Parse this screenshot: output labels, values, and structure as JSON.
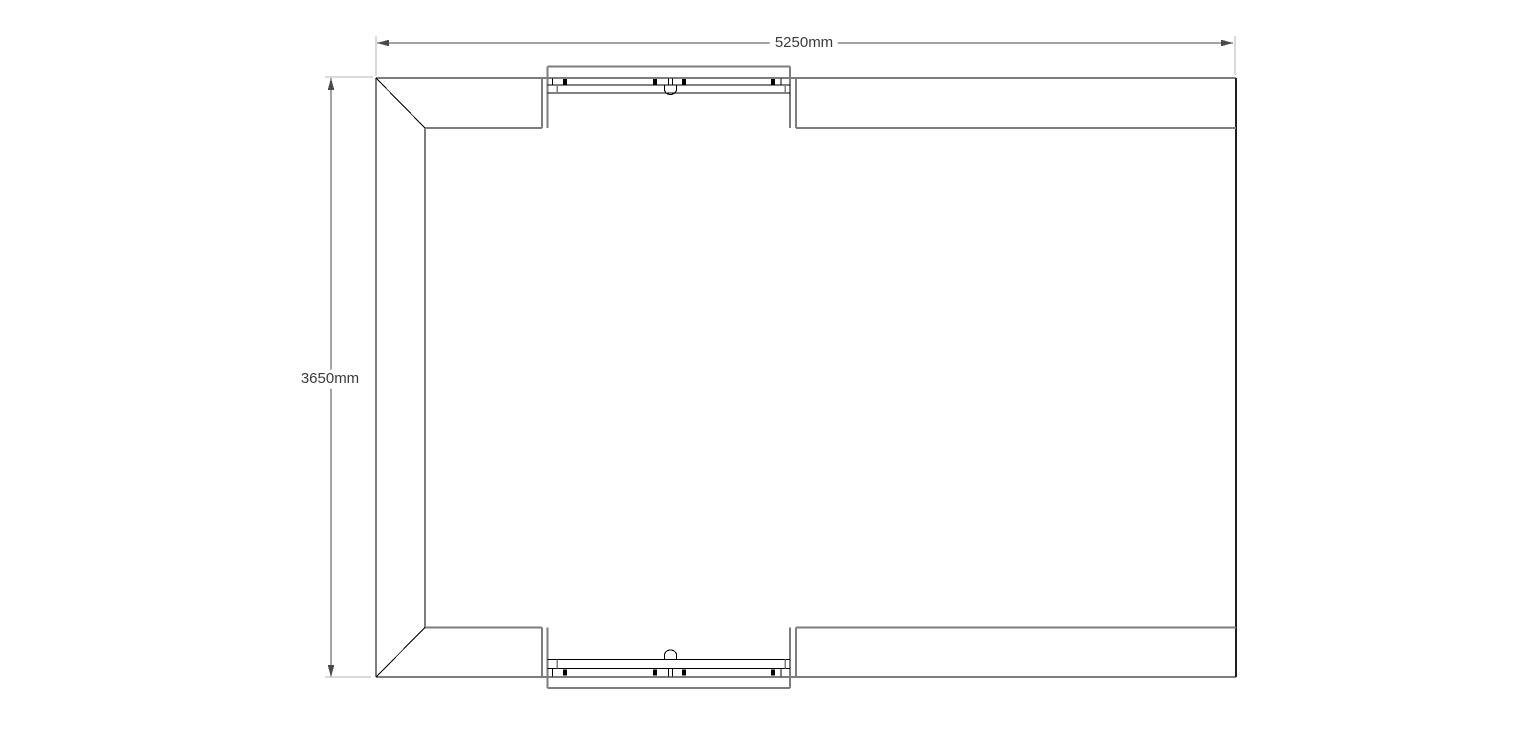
{
  "page": {
    "background": "#ffffff",
    "description": "CAD floor plan drawing, 5250mm x 3650mm unit with splayed left corners and sliding windows top and bottom"
  },
  "drawing": {
    "colors": {
      "wall": "#7d7d7d",
      "wall_dark": "#1f1f1f",
      "detail": "#000000",
      "dimension": "#4a4a4a",
      "extension": "#b4b4b4",
      "text": "#3a3a3a"
    },
    "dimensions": [
      {
        "id": "width",
        "label": "5250mm",
        "value_mm": 5250,
        "orientation": "horizontal",
        "label_center": {
          "x": 804,
          "y": 43
        }
      },
      {
        "id": "height",
        "label": "3650mm",
        "value_mm": 3650,
        "orientation": "vertical",
        "label_center": {
          "x": 330,
          "y": 379
        }
      }
    ],
    "elements": [
      {
        "name": "width-dim-line",
        "type": "line",
        "x1": 377,
        "y1": 43,
        "x2": 1233,
        "y2": 43,
        "stroke": "dimension",
        "w": 1
      },
      {
        "name": "width-dim-arrow-left",
        "type": "polygon",
        "points": "377,43 389,39.7 389,46.3",
        "fill": "dimension"
      },
      {
        "name": "width-dim-arrow-right",
        "type": "polygon",
        "points": "1233,43 1221,39.7 1221,46.3",
        "fill": "dimension"
      },
      {
        "name": "width-ext-line-left",
        "type": "line",
        "x1": 376,
        "y1": 36,
        "x2": 376,
        "y2": 76,
        "stroke": "extension",
        "w": 1
      },
      {
        "name": "width-ext-line-right",
        "type": "line",
        "x1": 1235,
        "y1": 36,
        "x2": 1235,
        "y2": 75,
        "stroke": "extension",
        "w": 1
      },
      {
        "name": "height-dim-line",
        "type": "line",
        "x1": 331,
        "y1": 78,
        "x2": 331,
        "y2": 677,
        "stroke": "dimension",
        "w": 1
      },
      {
        "name": "height-dim-arrow-top",
        "type": "polygon",
        "points": "331,78 327.7,90 334.3,90",
        "fill": "dimension"
      },
      {
        "name": "height-dim-arrow-bottom",
        "type": "polygon",
        "points": "331,677 327.7,665 334.3,665",
        "fill": "dimension"
      },
      {
        "name": "height-ext-line-top",
        "type": "line",
        "x1": 325,
        "y1": 77,
        "x2": 373,
        "y2": 77,
        "stroke": "extension",
        "w": 1
      },
      {
        "name": "height-ext-line-bottom",
        "type": "line",
        "x1": 325,
        "y1": 677,
        "x2": 371,
        "y2": 677,
        "stroke": "extension",
        "w": 1
      },
      {
        "name": "left-outer-wall",
        "type": "line",
        "x1": 376,
        "y1": 78,
        "x2": 376,
        "y2": 677,
        "stroke": "wall",
        "w": 2
      },
      {
        "name": "top-outer-wall",
        "type": "line",
        "x1": 376,
        "y1": 78,
        "x2": 1236,
        "y2": 78,
        "stroke": "wall",
        "w": 2
      },
      {
        "name": "bottom-outer-wall",
        "type": "line",
        "x1": 376,
        "y1": 677,
        "x2": 1236,
        "y2": 677,
        "stroke": "wall",
        "w": 2
      },
      {
        "name": "right-wall",
        "type": "line",
        "x1": 1236,
        "y1": 78,
        "x2": 1236,
        "y2": 677,
        "stroke": "wall_dark",
        "w": 2
      },
      {
        "name": "left-inner-wall",
        "type": "line",
        "x1": 425,
        "y1": 128,
        "x2": 425,
        "y2": 627.5,
        "stroke": "wall",
        "w": 2
      },
      {
        "name": "top-inner-wall-left",
        "type": "line",
        "x1": 425,
        "y1": 128,
        "x2": 542,
        "y2": 128,
        "stroke": "wall",
        "w": 2
      },
      {
        "name": "top-inner-wall-right",
        "type": "line",
        "x1": 796,
        "y1": 128,
        "x2": 1236,
        "y2": 128,
        "stroke": "wall",
        "w": 2
      },
      {
        "name": "bottom-inner-wall-left",
        "type": "line",
        "x1": 425,
        "y1": 627.5,
        "x2": 542,
        "y2": 627.5,
        "stroke": "wall",
        "w": 2
      },
      {
        "name": "bottom-inner-wall-right",
        "type": "line",
        "x1": 796,
        "y1": 627.5,
        "x2": 1236,
        "y2": 627.5,
        "stroke": "wall",
        "w": 2
      },
      {
        "name": "top-left-chamfer",
        "type": "line",
        "x1": 376,
        "y1": 78,
        "x2": 425,
        "y2": 128,
        "stroke": "detail",
        "w": 1
      },
      {
        "name": "bottom-left-chamfer",
        "type": "line",
        "x1": 376,
        "y1": 677,
        "x2": 425,
        "y2": 627.5,
        "stroke": "detail",
        "w": 1
      },
      {
        "name": "top-window-opening-left",
        "type": "line",
        "x1": 542,
        "y1": 78,
        "x2": 542,
        "y2": 128,
        "stroke": "wall",
        "w": 2
      },
      {
        "name": "top-window-opening-right",
        "type": "line",
        "x1": 796,
        "y1": 78,
        "x2": 796,
        "y2": 128,
        "stroke": "wall",
        "w": 2
      },
      {
        "name": "top-window-jamb-left",
        "type": "line",
        "x1": 547.5,
        "y1": 66.5,
        "x2": 547.5,
        "y2": 128,
        "stroke": "wall",
        "w": 2
      },
      {
        "name": "top-window-jamb-right",
        "type": "line",
        "x1": 790,
        "y1": 66.5,
        "x2": 790,
        "y2": 128,
        "stroke": "wall",
        "w": 2
      },
      {
        "name": "top-window-frame-outer",
        "type": "line",
        "x1": 547.5,
        "y1": 66.5,
        "x2": 790,
        "y2": 66.5,
        "stroke": "wall",
        "w": 2
      },
      {
        "name": "top-window-rail-1",
        "type": "line",
        "x1": 547.5,
        "y1": 85,
        "x2": 790,
        "y2": 85,
        "stroke": "detail",
        "w": 1
      },
      {
        "name": "top-window-rail-2",
        "type": "line",
        "x1": 547.5,
        "y1": 93,
        "x2": 790,
        "y2": 93,
        "stroke": "detail",
        "w": 1
      },
      {
        "name": "top-window-lock-block",
        "type": "rect",
        "x": 563.2,
        "y": 79,
        "width": 3.6,
        "height": 6,
        "fill": "detail"
      },
      {
        "name": "top-window-lock-block",
        "type": "rect",
        "x": 653.2,
        "y": 79,
        "width": 3.6,
        "height": 6,
        "fill": "detail"
      },
      {
        "name": "top-window-lock-block",
        "type": "rect",
        "x": 682.2,
        "y": 79,
        "width": 3.6,
        "height": 6,
        "fill": "detail"
      },
      {
        "name": "top-window-lock-block",
        "type": "rect",
        "x": 771.2,
        "y": 79,
        "width": 3.6,
        "height": 6,
        "fill": "detail"
      },
      {
        "name": "top-window-mullion",
        "type": "line",
        "x1": 552.5,
        "y1": 78.5,
        "x2": 552.5,
        "y2": 85,
        "stroke": "detail",
        "w": 1
      },
      {
        "name": "top-window-interlock-a",
        "type": "line",
        "x1": 668.5,
        "y1": 78.5,
        "x2": 668.5,
        "y2": 85,
        "stroke": "detail",
        "w": 1
      },
      {
        "name": "top-window-interlock-b",
        "type": "line",
        "x1": 672.5,
        "y1": 78.5,
        "x2": 672.5,
        "y2": 85,
        "stroke": "detail",
        "w": 1
      },
      {
        "name": "top-window-mullion",
        "type": "line",
        "x1": 781,
        "y1": 78.5,
        "x2": 781,
        "y2": 85,
        "stroke": "detail",
        "w": 1
      },
      {
        "name": "top-window-sash-tick",
        "type": "line",
        "x1": 557,
        "y1": 85,
        "x2": 557,
        "y2": 93,
        "stroke": "wall",
        "w": 1.5
      },
      {
        "name": "top-window-sash-tick",
        "type": "line",
        "x1": 785,
        "y1": 85,
        "x2": 785,
        "y2": 93,
        "stroke": "wall",
        "w": 1.5
      },
      {
        "name": "top-window-latch",
        "type": "path",
        "d": "M664.5,85 L664.5,89.5 A6,5 0 0 0 676.5,89.5 L676.5,85",
        "stroke": "detail",
        "w": 1,
        "fill": "none"
      },
      {
        "name": "bottom-window-opening-left",
        "type": "line",
        "x1": 542,
        "y1": 627.5,
        "x2": 542,
        "y2": 677,
        "stroke": "wall",
        "w": 2
      },
      {
        "name": "bottom-window-opening-right",
        "type": "line",
        "x1": 796,
        "y1": 627.5,
        "x2": 796,
        "y2": 677,
        "stroke": "wall",
        "w": 2
      },
      {
        "name": "bottom-window-jamb-left",
        "type": "line",
        "x1": 547.5,
        "y1": 627.5,
        "x2": 547.5,
        "y2": 688,
        "stroke": "wall",
        "w": 2
      },
      {
        "name": "bottom-window-jamb-right",
        "type": "line",
        "x1": 790,
        "y1": 627.5,
        "x2": 790,
        "y2": 688,
        "stroke": "wall",
        "w": 2
      },
      {
        "name": "bottom-window-frame-outer",
        "type": "line",
        "x1": 547.5,
        "y1": 688,
        "x2": 790,
        "y2": 688,
        "stroke": "wall",
        "w": 2
      },
      {
        "name": "bottom-window-rail-1",
        "type": "line",
        "x1": 547.5,
        "y1": 668.5,
        "x2": 790,
        "y2": 668.5,
        "stroke": "detail",
        "w": 1
      },
      {
        "name": "bottom-window-rail-2",
        "type": "line",
        "x1": 547.5,
        "y1": 659.5,
        "x2": 790,
        "y2": 659.5,
        "stroke": "detail",
        "w": 1
      },
      {
        "name": "bottom-window-lock-block",
        "type": "rect",
        "x": 563.2,
        "y": 669.5,
        "width": 3.6,
        "height": 6,
        "fill": "detail"
      },
      {
        "name": "bottom-window-lock-block",
        "type": "rect",
        "x": 653.2,
        "y": 669.5,
        "width": 3.6,
        "height": 6,
        "fill": "detail"
      },
      {
        "name": "bottom-window-lock-block",
        "type": "rect",
        "x": 682.2,
        "y": 669.5,
        "width": 3.6,
        "height": 6,
        "fill": "detail"
      },
      {
        "name": "bottom-window-lock-block",
        "type": "rect",
        "x": 771.2,
        "y": 669.5,
        "width": 3.6,
        "height": 6,
        "fill": "detail"
      },
      {
        "name": "bottom-window-mullion",
        "type": "line",
        "x1": 552.5,
        "y1": 668.5,
        "x2": 552.5,
        "y2": 676.5,
        "stroke": "detail",
        "w": 1
      },
      {
        "name": "bottom-window-interlock-a",
        "type": "line",
        "x1": 668.5,
        "y1": 668.5,
        "x2": 668.5,
        "y2": 676.5,
        "stroke": "detail",
        "w": 1
      },
      {
        "name": "bottom-window-interlock-b",
        "type": "line",
        "x1": 672.5,
        "y1": 668.5,
        "x2": 672.5,
        "y2": 676.5,
        "stroke": "detail",
        "w": 1
      },
      {
        "name": "bottom-window-mullion",
        "type": "line",
        "x1": 781,
        "y1": 668.5,
        "x2": 781,
        "y2": 676.5,
        "stroke": "detail",
        "w": 1
      },
      {
        "name": "bottom-window-sash-tick",
        "type": "line",
        "x1": 557,
        "y1": 659.5,
        "x2": 557,
        "y2": 668.5,
        "stroke": "wall",
        "w": 1.5
      },
      {
        "name": "bottom-window-sash-tick",
        "type": "line",
        "x1": 785,
        "y1": 659.5,
        "x2": 785,
        "y2": 668.5,
        "stroke": "wall",
        "w": 1.5
      },
      {
        "name": "bottom-window-latch",
        "type": "path",
        "d": "M664.5,659.5 L664.5,655 A6,5 0 0 1 676.5,655 L676.5,659.5",
        "stroke": "detail",
        "w": 1,
        "fill": "none"
      }
    ]
  }
}
